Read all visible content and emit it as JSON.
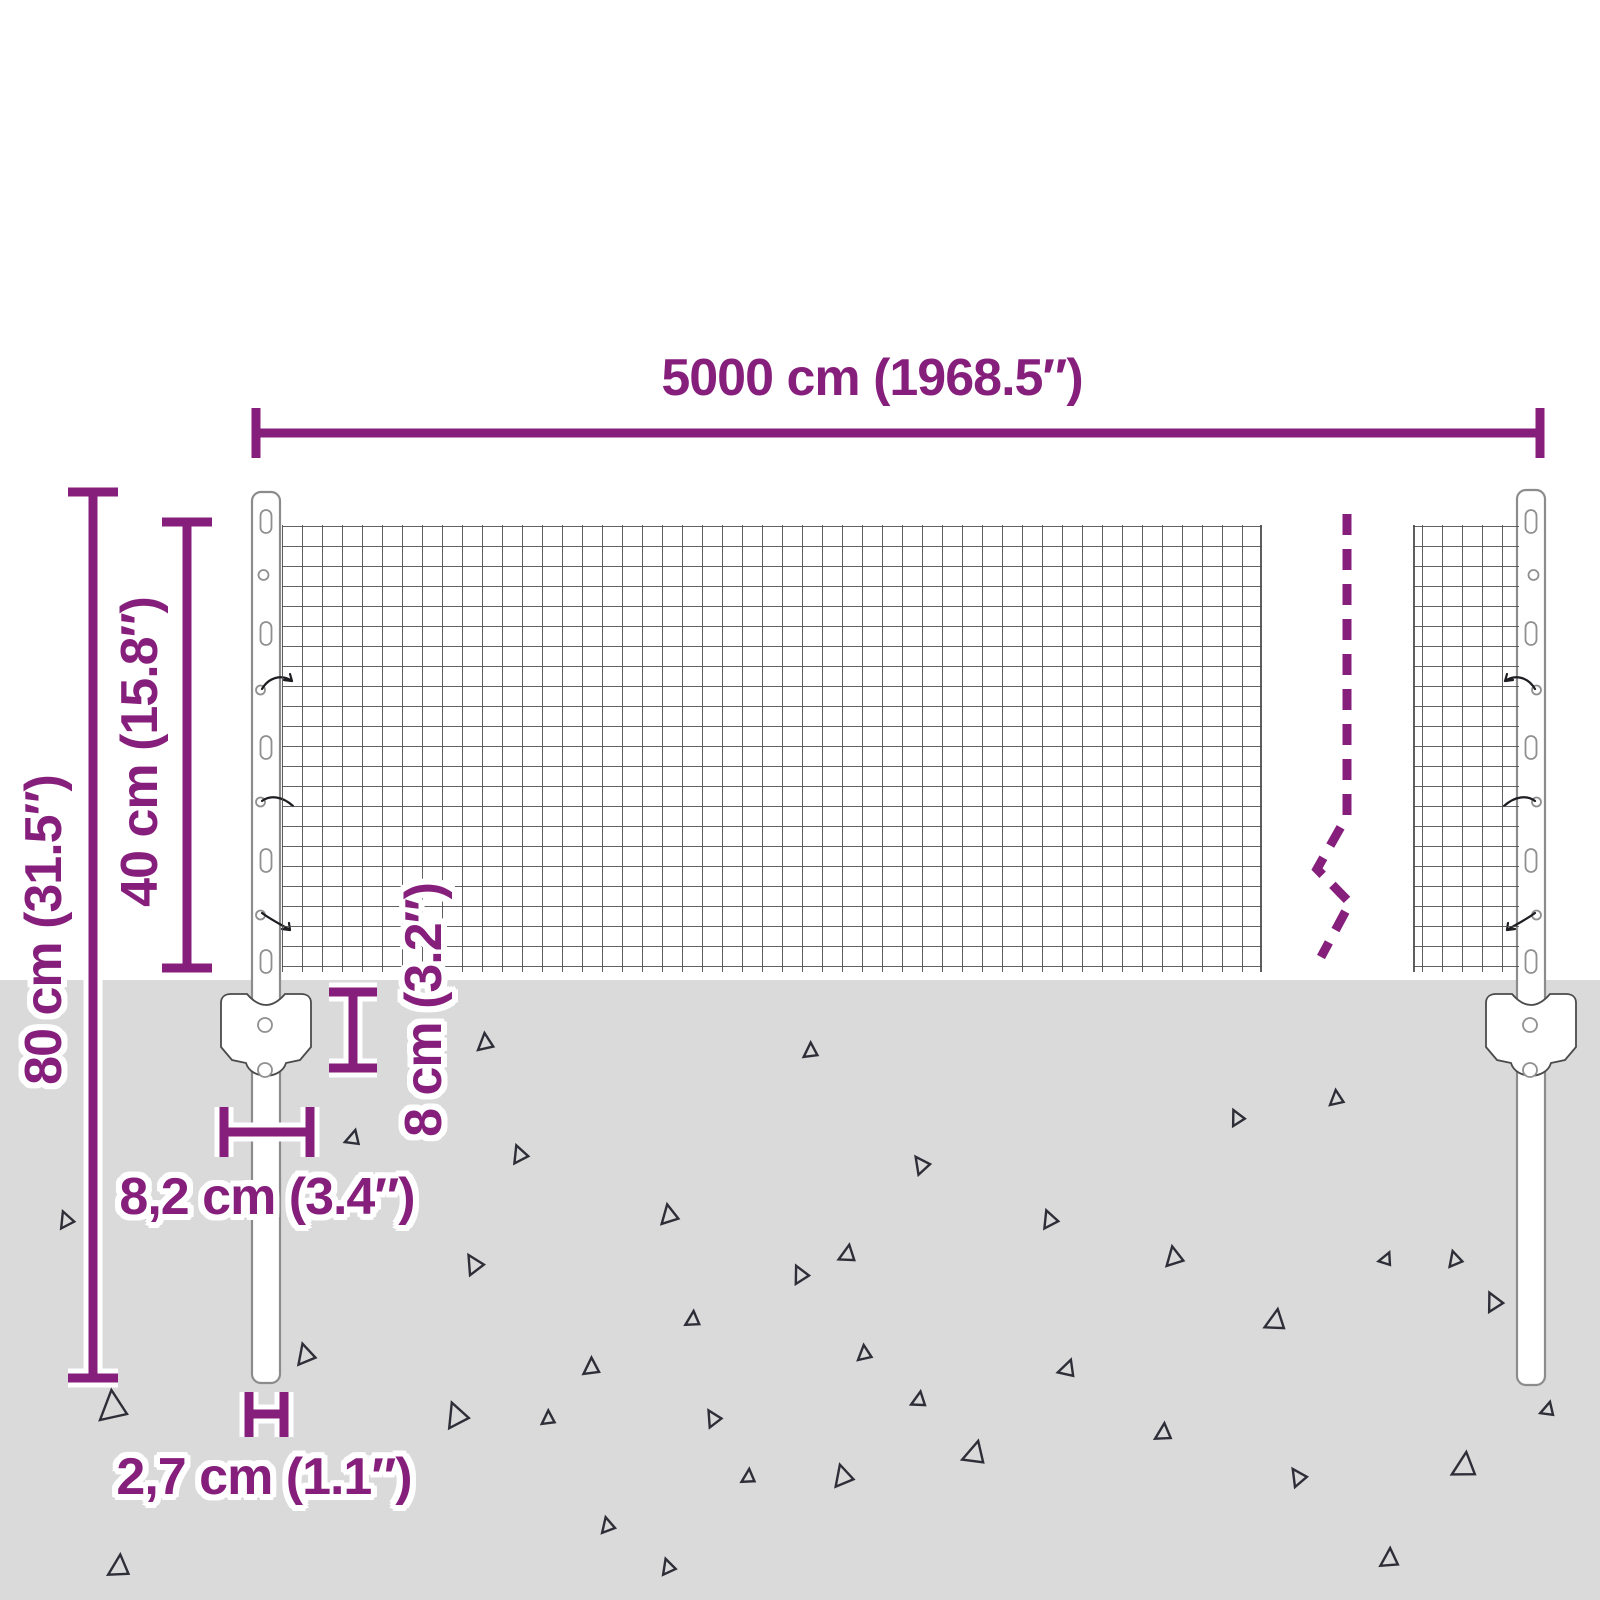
{
  "product_diagram": {
    "labels": {
      "total_width": "5000 cm (1968.5″)",
      "mesh_height": "40 cm (15.8″)",
      "post_height": "80 cm (31.5″)",
      "underground_depth": "8 cm (3.2″)",
      "anchor_width": "8,2 cm (3.4″)",
      "post_diameter": "2,7 cm (1.1″)"
    },
    "colors": {
      "accent": "#861F7C",
      "ground": "#DADADA",
      "mesh_line": "#4D4D4D",
      "post_outline": "#8C8C8C",
      "triangle": "#2E2E38"
    },
    "ground": {
      "triangles": [
        [
          100,
          1390,
          30,
          0
        ],
        [
          57,
          1213,
          16,
          -15
        ],
        [
          112,
          1553,
          22,
          10
        ],
        [
          253,
          1460,
          16,
          40
        ],
        [
          295,
          1345,
          20,
          -10
        ],
        [
          350,
          1128,
          15,
          20
        ],
        [
          478,
          1033,
          17,
          0
        ],
        [
          510,
          1147,
          17,
          -15
        ],
        [
          462,
          1258,
          19,
          -25
        ],
        [
          585,
          1357,
          17,
          5
        ],
        [
          660,
          1205,
          19,
          -5
        ],
        [
          688,
          1310,
          15,
          10
        ],
        [
          790,
          1268,
          17,
          -20
        ],
        [
          805,
          1042,
          15,
          5
        ],
        [
          843,
          1243,
          17,
          15
        ],
        [
          910,
          1160,
          17,
          -30
        ],
        [
          858,
          1345,
          15,
          0
        ],
        [
          832,
          1466,
          21,
          -10
        ],
        [
          970,
          1438,
          23,
          20
        ],
        [
          1040,
          1212,
          17,
          -15
        ],
        [
          1065,
          1357,
          17,
          25
        ],
        [
          1165,
          1247,
          19,
          -5
        ],
        [
          1158,
          1422,
          17,
          10
        ],
        [
          1228,
          1112,
          15,
          -20
        ],
        [
          1270,
          1307,
          21,
          15
        ],
        [
          1330,
          1090,
          15,
          0
        ],
        [
          1385,
          1250,
          13,
          30
        ],
        [
          1447,
          1252,
          15,
          -10
        ],
        [
          1457,
          1450,
          25,
          12
        ],
        [
          1287,
          1472,
          17,
          -28
        ],
        [
          1383,
          1547,
          19,
          8
        ],
        [
          660,
          1560,
          15,
          -12
        ],
        [
          1545,
          1400,
          14,
          20
        ],
        [
          443,
          1405,
          24,
          -15
        ],
        [
          543,
          1410,
          14,
          5
        ],
        [
          703,
          1413,
          16,
          -25
        ],
        [
          744,
          1468,
          14,
          10
        ],
        [
          600,
          1518,
          15,
          -8
        ],
        [
          915,
          1390,
          15,
          15
        ],
        [
          1483,
          1295,
          18,
          -20
        ]
      ]
    }
  }
}
